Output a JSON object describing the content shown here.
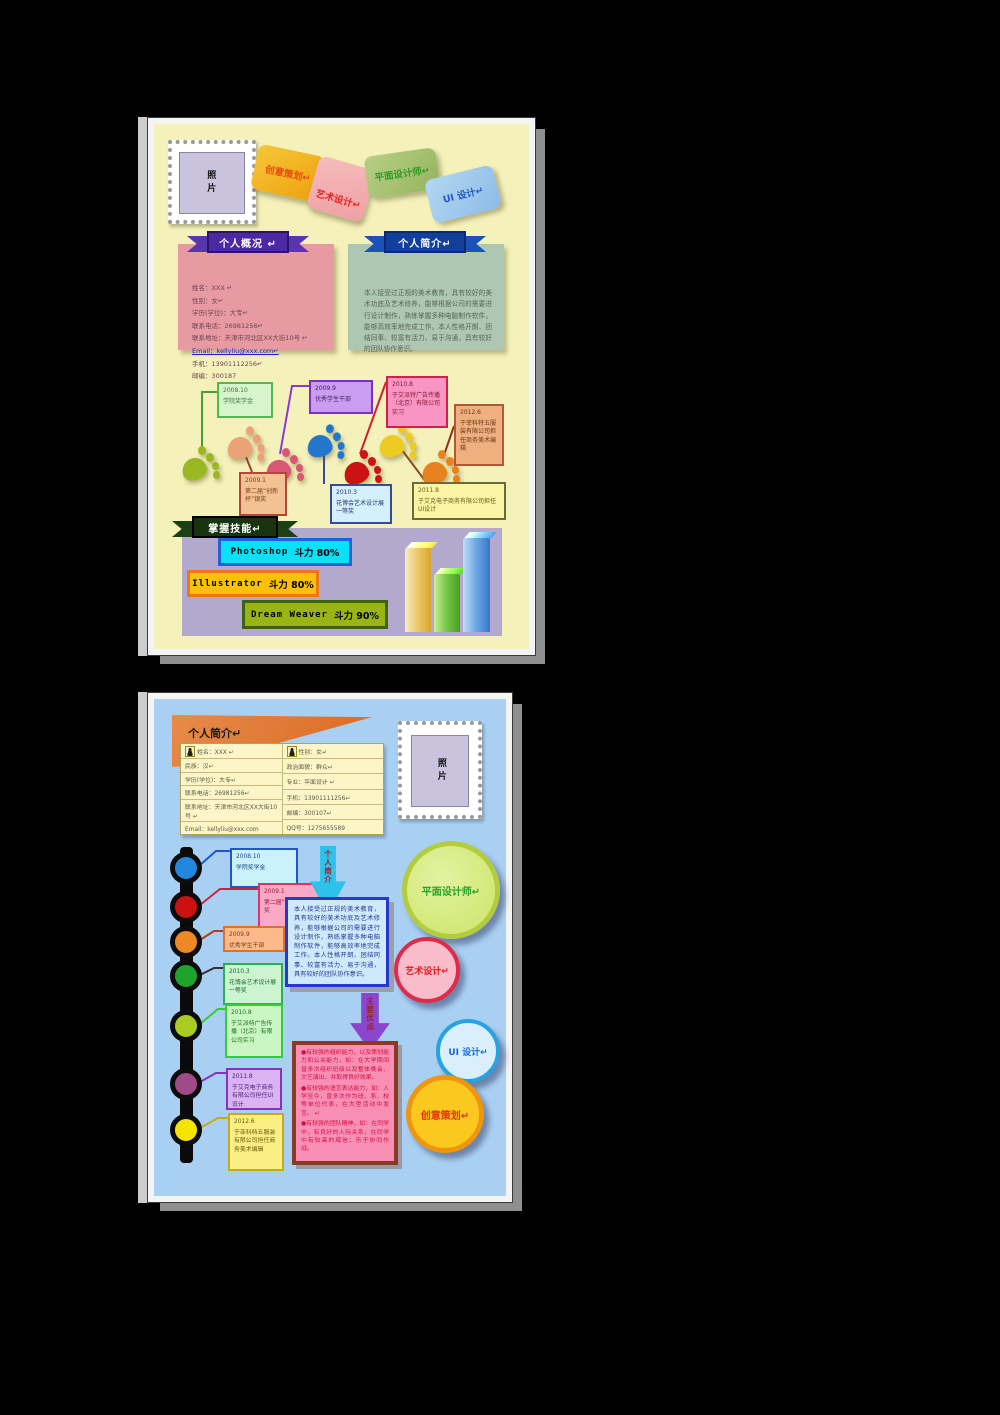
{
  "colors": {
    "page1_bg": "#f5f1ba",
    "page2_bg": "#a9d0f3",
    "card_orange": "#eda10c",
    "card_pink": "#eea0a4",
    "card_green": "#93b45e",
    "card_blue": "#8cbbe8",
    "ribbon_purple": "#4c28a2",
    "ribbon_navy": "#123f9c",
    "ribbon_darkgreen": "#16340e",
    "skill_cyan": "#0ae0f8",
    "skill_orange": "#fdc008",
    "skill_green": "#9ab513",
    "banner2_orange": "#d96a24"
  },
  "page1": {
    "stamp": {
      "l1": "照",
      "l2": "片"
    },
    "cards": [
      "创意策划↵",
      "艺术设计↵",
      "平面设计师↵",
      "UI 设计↵"
    ],
    "banner_profile": "个人概况 ↵",
    "banner_intro": "个人简介↵",
    "profile_lines": [
      "姓名：XXX ↵",
      "性别：女↵",
      "学历(学位)：大专↵",
      "联系电话：26981256↵",
      "联系地址：天津市河北区XX大街10号 ↵",
      "Email：kellyliu@xxx.com↵",
      "手机：13901112256↵",
      "邮编：300187"
    ],
    "intro_text": "本人接受过正规的美术教育，具有较好的美术功底及艺术修养，能够根据公司的需要进行设计制作，熟练掌握多种电脑制作软件，能够高效率地完成工作。本人性格开朗、团结同事、较富有活力、易于沟通，具有较好的团队协作意识。",
    "timeline": [
      {
        "date": "2008.10",
        "text": "学院奖学金"
      },
      {
        "date": "2009.9",
        "text": "优秀学生干部"
      },
      {
        "date": "2010.8",
        "text": "于艾派特广告传播（北京）有限公司实习"
      },
      {
        "date": "2012.6",
        "text": "于菲科特五服装有限公司担任商务美术编辑"
      },
      {
        "date": "2009.1",
        "text": "第二届“创新杯”银奖"
      },
      {
        "date": "2010.3",
        "text": "花博会艺术设计展一等奖"
      },
      {
        "date": "2011.8",
        "text": "于艾克电子商务有限公司担任UI设计"
      }
    ],
    "banner_skills": "掌握技能↵",
    "skills": [
      {
        "name": "Photoshop",
        "level": "斗力 80%"
      },
      {
        "name": "Illustrator",
        "level": "斗力 80%"
      },
      {
        "name": "Dream Weaver",
        "level": "斗力 90%"
      }
    ]
  },
  "page2": {
    "header": "个人简介↵",
    "stamp": {
      "l1": "照",
      "l2": "片"
    },
    "info_left": [
      "姓名：XXX ↵",
      "民族：汉↵",
      "学历(学位)：大专↵",
      "联系电话：26981256↵",
      "联系地址：天津市河北区XX大街10号 ↵",
      "Email：kellyliu@xxx.com"
    ],
    "info_right": [
      "性别：女↵",
      "政治面貌：群众↵",
      "专业：平面设计 ↵",
      "手机：13901111256↵",
      "邮编：300107↵",
      "QQ号：1275655589"
    ],
    "arrow_intro": "个人简介",
    "arrow_strength": "主要优点",
    "intro_text": "本人接受过正规的美术教育，具有较好的美术功底及艺术修养，能够根据公司的需要进行设计制作，熟练掌握多种电脑制作软件，能够高效率地完成工作。本人性格开朗、团结同事、较富有活力、易于沟通，具有较好的团队协作意识。",
    "timeline": [
      {
        "date": "2008.10",
        "text": "学院奖学金"
      },
      {
        "date": "2009.1",
        "text": "第二届“创新杯”银奖"
      },
      {
        "date": "2009.9",
        "text": "优秀学生干部"
      },
      {
        "date": "2010.3",
        "text": "花博会艺术设计展一等奖"
      },
      {
        "date": "2010.8",
        "text": "于艾派特广告传播（北京）有限公司实习"
      },
      {
        "date": "2011.8",
        "text": "于艾克电子商务有限公司担任UI设计"
      },
      {
        "date": "2012.6",
        "text": "于菲科特五服装有限公司担任商务美术编辑"
      }
    ],
    "strengths": [
      "●有较强的组织能力，以及策划能力和公关能力，如：在大学期间曾多次组织班级以及整体晚会、文艺演出，并取得良好效果。",
      "●有较强的语言表达能力，如：入学至今，曾多次作为班、系、校等单位代表，在大型活动中发言。 ↵",
      "●有较强的团队精神，如：在同学中，有良好的人际关系，在同学中有较高的威信；乐于协同作战。"
    ],
    "circles": [
      "平面设计师↵",
      "艺术设计↵",
      "UI 设计↵",
      "创意策划↵"
    ]
  }
}
